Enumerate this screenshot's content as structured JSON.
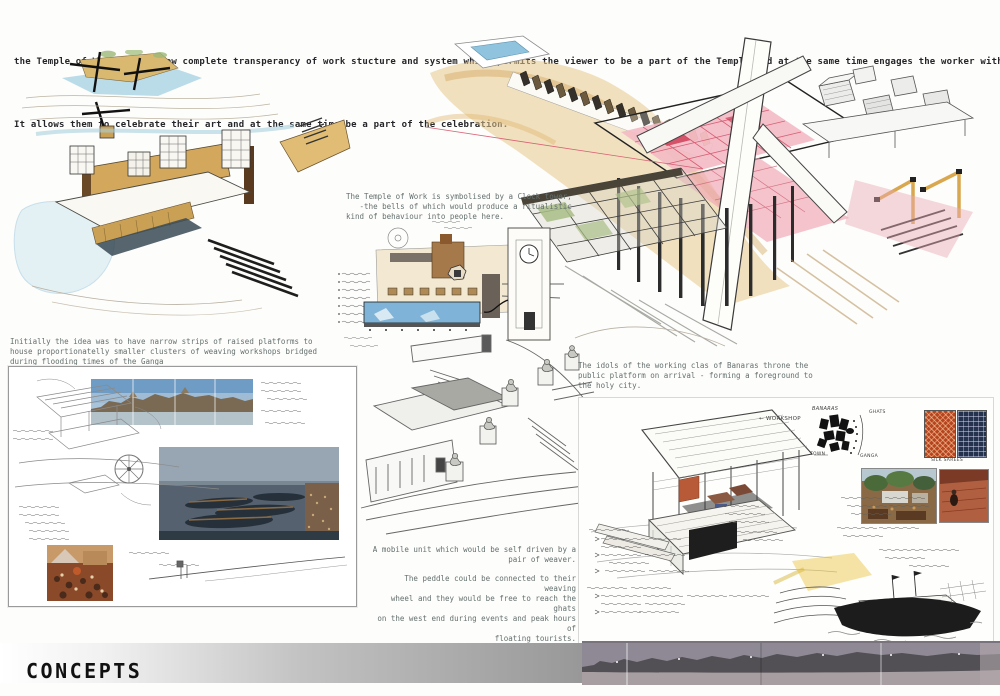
{
  "page": {
    "title": "CONCEPTS",
    "intro": {
      "line1": "the Temple of Work must allow complete transperancy of work stucture and system which permits the viewer to be a part of the Temple and at the same time engages the worker with the outside.",
      "line2": "It allows them to celebrate their art and at the same time be a part of the celebration."
    }
  },
  "captions": {
    "clock_tower": "The Temple of Work is symbolised by a Clock tower,\n   -the bells of which would produce a ritualistic\nkind of behaviour into people here.",
    "raised_platforms": "Initially the idea was to have narrow strips of raised platforms to\nhouse proportionatelly smaller clusters of weaving workshops bridged\nduring flooding times of the Ganga",
    "idols": "The idols of the working clas of Banaras throne the\npublic platform on arrival - forming a foreground to\nthe holy city.",
    "mobile_unit_p1": "A mobile unit which would be self driven by a\npair of weaver.",
    "mobile_unit_p2": "The peddle could be connected to their weaving\nwheel and they would be free to reach the ghats\non the west end during events and peak hours of\nfloating tourists.",
    "mobile_unit_p3": "This not only provides direct advertisement but\nalso redces exploitation of these artists."
  },
  "panel_right": {
    "workshop_label": "← WORKSHOP",
    "map": {
      "title": "BANARAS",
      "ghats": "GHATS",
      "town": "TOWN",
      "ganga": "GANGA"
    },
    "swatch_caption": "SILK SAREES"
  },
  "colors": {
    "paper": "#fdfdfb",
    "sand": "#e3bf7f",
    "water_blue": "#8fc3de",
    "grid_pink": "#f3bac4",
    "grid_red": "#d5536b",
    "pencil_gray": "#6a6a6a",
    "bar_gray": "#9a9a9a"
  }
}
